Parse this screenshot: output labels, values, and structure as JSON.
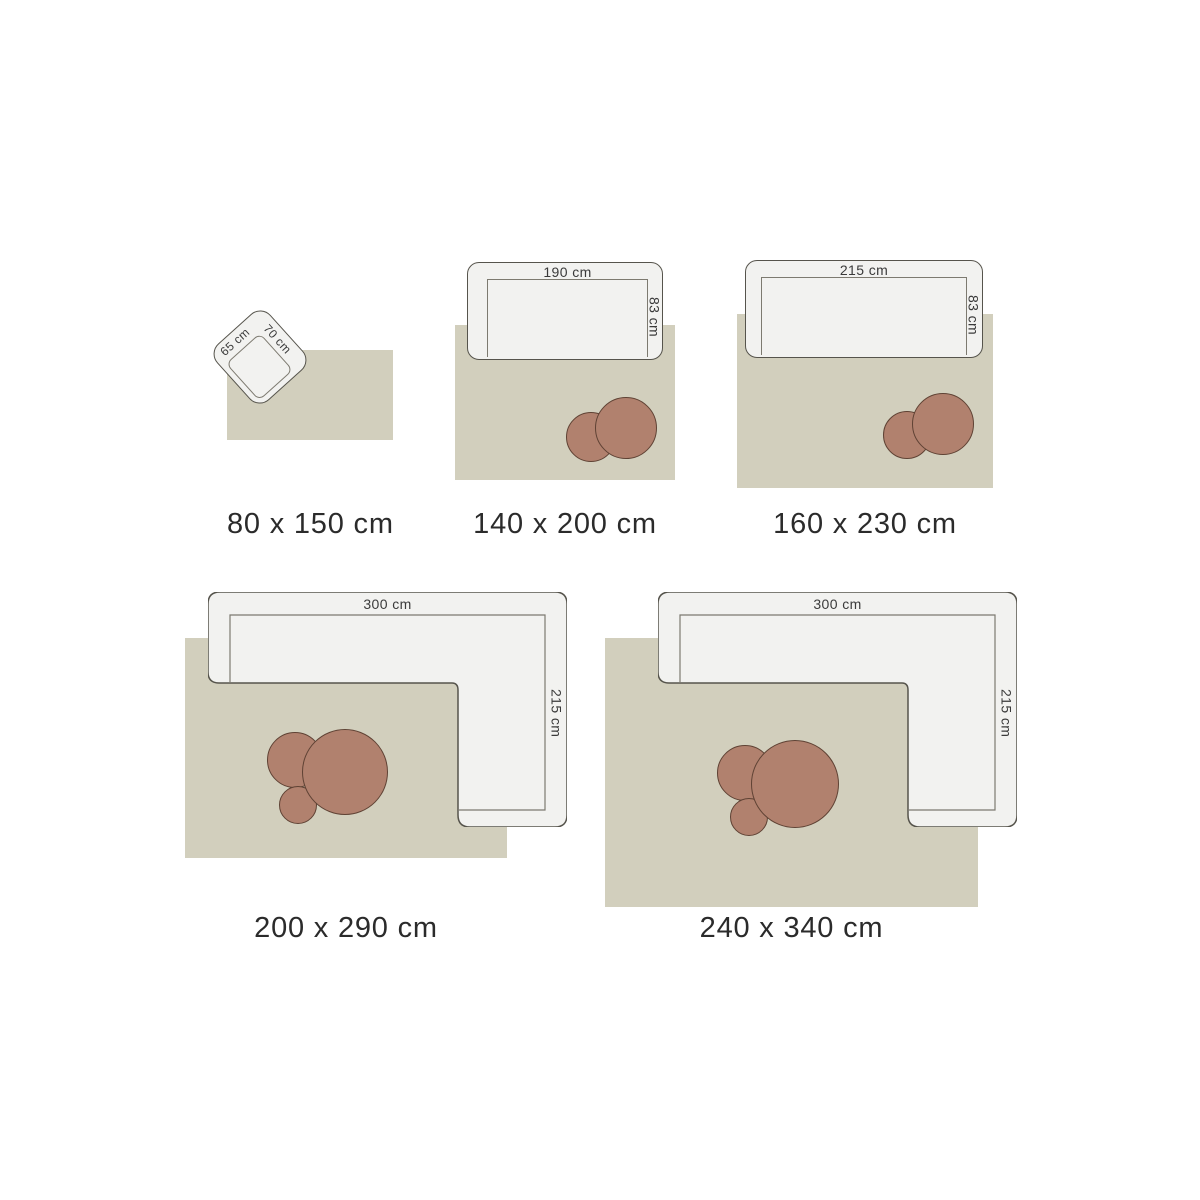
{
  "guide_type": "rug-size-guide",
  "colors": {
    "rug": "#d2cfbd",
    "sofa-fill": "#f2f2f0",
    "sofa-border": "#56544c",
    "seat-line": "#7d7a70",
    "table-fill": "#b1816e",
    "table-border": "#5f4234",
    "label-color": "#2b2b2b",
    "dim-color": "#3a3a3a"
  },
  "diagrams": [
    {
      "rug_label": "80 x 150 cm",
      "furniture": "armchair",
      "width_label": "65 cm",
      "depth_label": "70 cm"
    },
    {
      "rug_label": "140 x 200 cm",
      "furniture": "sofa",
      "width_label": "190 cm",
      "depth_label": "83 cm",
      "coffee_tables": 2
    },
    {
      "rug_label": "160 x 230 cm",
      "furniture": "sofa",
      "width_label": "215 cm",
      "depth_label": "83 cm",
      "coffee_tables": 2
    },
    {
      "rug_label": "200 x 290 cm",
      "furniture": "corner-sofa",
      "width_label": "300 cm",
      "depth_label": "215 cm",
      "coffee_tables": 3
    },
    {
      "rug_label": "240 x 340 cm",
      "furniture": "corner-sofa",
      "width_label": "300 cm",
      "depth_label": "215 cm",
      "coffee_tables": 3
    }
  ]
}
